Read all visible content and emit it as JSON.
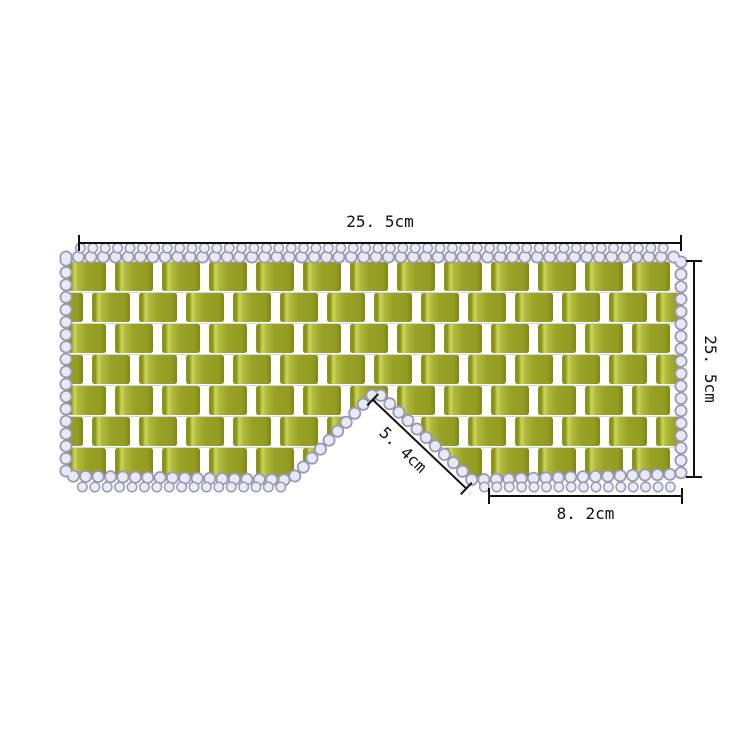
{
  "product": {
    "description": "beaded jade eye mask with woven green tiles and clear bead border"
  },
  "annotations": {
    "top_width": {
      "label": "25. 5cm"
    },
    "right_height": {
      "label": "25. 5cm"
    },
    "nose_bridge": {
      "label": "5. 4cm"
    },
    "bottom_right_width": {
      "label": "8. 2cm"
    }
  },
  "colors": {
    "background": "#ffffff",
    "tile_green": "#99a226",
    "tile_highlight": "#ccd659",
    "tile_shadow": "#828b14",
    "bead_fill": "#e9e9f4",
    "bead_outline": "#9898b6",
    "dimension_line": "#101010"
  }
}
